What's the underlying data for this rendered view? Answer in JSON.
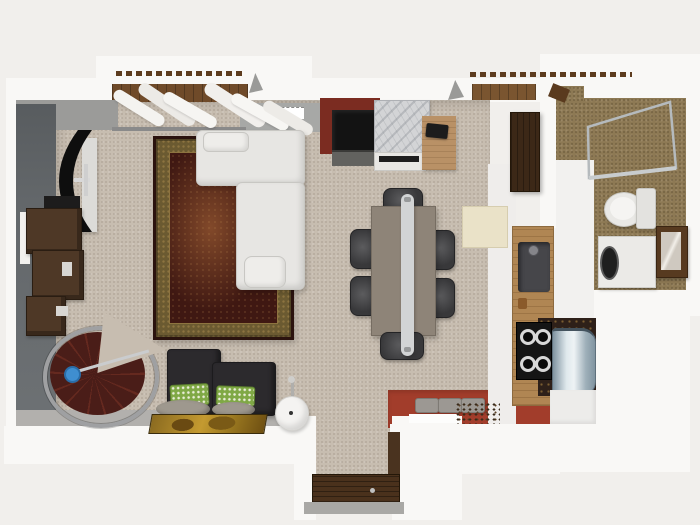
{
  "meta": {
    "title": "3D apartment floor plan render, top-down view",
    "canvas": {
      "width": 700,
      "height": 525
    },
    "visible_text": "none"
  },
  "palette": {
    "bg": "#f1efec",
    "wallWhite": "#f9f8f6",
    "wallSoft": "#efedeb",
    "wallGrayLeft": "#63676a",
    "wallGrayTop": "#9b9b99",
    "wallGrayTop2": "#a7a8a6",
    "wallGraySouth": "#b2b0ad",
    "threshold": "#a9a8a5",
    "carpet": "#c7bdb0",
    "redFloor": "#a23d2b",
    "redWall": "#7b2c21",
    "bathFloor": "#8d7954",
    "woodDeck": "#6f4a29",
    "lintelBrown": "#5d3c1e",
    "rugField": "#3f1812",
    "rugBorder": "#6b5a31",
    "rugBorderDot": "#8d7440",
    "rugEdge": "#2b130e",
    "rugGlow": "#82492a",
    "sofaWhite": "#e7e6e3",
    "sofaHi": "#eeedea",
    "sofaBorder": "#c8c7c3",
    "tvBlack": "#0e0e0e",
    "tvPanel": "#dcdbd8",
    "shelfBrown": "#4e3826",
    "slabBlack": "#1d1c1c",
    "stairStep": "#4a1d18",
    "stairStep2": "#65291f",
    "stairRail": "#9fa0a2",
    "stairHub": "#3f8ed0",
    "darkSofa": "#2c2a2d",
    "pillowGreen": "#7fa845",
    "pillowDot": "#e9edd8",
    "cushionGray": "#9e988e",
    "paintGold1": "#8a6a20",
    "paintGold2": "#c49a30",
    "tableTaupe": "#8e8478",
    "chairDark": "#38383a",
    "chairHi": "#5c5c5e",
    "lightBar": "#d2d4d5",
    "marble": "#d3d4d6",
    "fridgeBlack": "#131313",
    "fridgeBase": "#62625f",
    "deskWood": "#b99166",
    "doorWood": "#3c2817",
    "counterWood": "#b08653",
    "sinkGray": "#46464a",
    "cooktopBlack": "#151515",
    "counterDark": "#2e2019",
    "steelLight": "#eef3f5",
    "steelMid": "#9fb0ba",
    "steelDark": "#8194a0",
    "cabinetWhite": "#edecea",
    "creamRect": "#eae2c8",
    "toiletWhite": "#e9e8e5",
    "washerWhite": "#ebeae7",
    "mirrorBrown": "#573a20",
    "mirrorInner": "#cfc9c0",
    "benchGray": "#9c9893",
    "entryDoor": "#4a311c",
    "showerGlass": "#b5babd"
  },
  "rooms": [
    {
      "id": "living-room",
      "floor": "beige carpet"
    },
    {
      "id": "dining-area",
      "floor": "beige carpet"
    },
    {
      "id": "kitchen",
      "floor": "red tile"
    },
    {
      "id": "bathroom",
      "floor": "brown tile"
    },
    {
      "id": "entry-hall",
      "floor": "beige carpet with wood door"
    },
    {
      "id": "balcony",
      "floor": "wood deck"
    }
  ],
  "furniture": [
    {
      "room": "living-room",
      "id": "curved-tv"
    },
    {
      "room": "living-room",
      "id": "tv-stand-panel"
    },
    {
      "room": "living-room",
      "id": "bookshelf-units"
    },
    {
      "room": "living-room",
      "id": "oriental-rug"
    },
    {
      "room": "living-room",
      "id": "white-sectional-sofa"
    },
    {
      "room": "living-room",
      "id": "spiral-staircase"
    },
    {
      "room": "living-room",
      "id": "dark-loveseat"
    },
    {
      "room": "living-room",
      "id": "green-pattern-pillows"
    },
    {
      "room": "living-room",
      "id": "gray-floor-cushions"
    },
    {
      "room": "living-room",
      "id": "gold-painting"
    },
    {
      "room": "living-room",
      "id": "white-pedestal-table"
    },
    {
      "room": "living-room",
      "id": "window-curtains"
    },
    {
      "room": "dining-area",
      "id": "dining-table"
    },
    {
      "room": "dining-area",
      "id": "six-dark-chairs"
    },
    {
      "room": "dining-area",
      "id": "linear-pendant-light"
    },
    {
      "room": "dining-area",
      "id": "cream-mat"
    },
    {
      "room": "kitchen",
      "id": "black-refrigerator"
    },
    {
      "room": "kitchen",
      "id": "marble-island"
    },
    {
      "room": "kitchen",
      "id": "wood-desk-with-laptop"
    },
    {
      "room": "kitchen",
      "id": "open-wood-door"
    },
    {
      "room": "kitchen",
      "id": "wood-countertop"
    },
    {
      "room": "kitchen",
      "id": "sink"
    },
    {
      "room": "kitchen",
      "id": "gas-cooktop"
    },
    {
      "room": "kitchen",
      "id": "stainless-appliance"
    },
    {
      "room": "kitchen",
      "id": "step-benches"
    },
    {
      "room": "bathroom",
      "id": "glass-shower"
    },
    {
      "room": "bathroom",
      "id": "toilet"
    },
    {
      "room": "bathroom",
      "id": "washing-machine"
    },
    {
      "room": "bathroom",
      "id": "framed-mirror"
    },
    {
      "room": "entry-hall",
      "id": "front-door"
    }
  ]
}
